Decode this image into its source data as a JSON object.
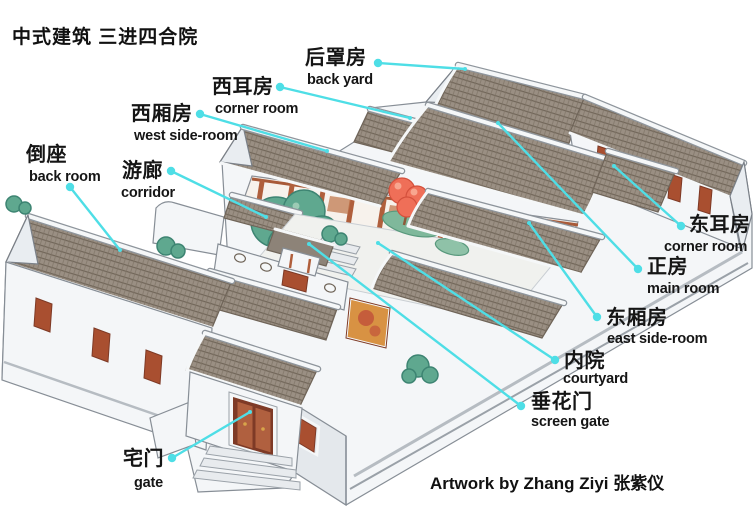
{
  "title": {
    "text": "中式建筑 三进四合院"
  },
  "credit": {
    "text": "Artwork by Zhang Ziyi 张紫仪"
  },
  "style": {
    "leader_color": "#4edee6",
    "text_color": "#151515"
  },
  "labels": [
    {
      "id": "hou-zhao-fang",
      "cn": "后罩房",
      "en": "back yard",
      "cn_pos": [
        305,
        48
      ],
      "en_pos": [
        307,
        73
      ],
      "dot": [
        378,
        63
      ],
      "end": [
        465,
        69
      ]
    },
    {
      "id": "xi-er-fang",
      "cn": "西耳房",
      "en": "corner room",
      "cn_pos": [
        212,
        77
      ],
      "en_pos": [
        215,
        102
      ],
      "dot": [
        280,
        87
      ],
      "end": [
        410,
        118
      ]
    },
    {
      "id": "xi-xiang-fang",
      "cn": "西厢房",
      "en": "west side-room",
      "cn_pos": [
        131,
        104
      ],
      "en_pos": [
        134,
        129
      ],
      "dot": [
        200,
        114
      ],
      "end": [
        327,
        151
      ]
    },
    {
      "id": "you-lang",
      "cn": "游廊",
      "en": "corridor",
      "cn_pos": [
        122,
        161
      ],
      "en_pos": [
        121,
        186
      ],
      "dot": [
        171,
        171
      ],
      "end": [
        266,
        217
      ]
    },
    {
      "id": "dao-zuo",
      "cn": "倒座",
      "en": "back room",
      "cn_pos": [
        26,
        145
      ],
      "en_pos": [
        29,
        170
      ],
      "dot": [
        70,
        187
      ],
      "end": [
        120,
        250
      ]
    },
    {
      "id": "zhai-men",
      "cn": "宅门",
      "en": "gate",
      "cn_pos": [
        123,
        449
      ],
      "en_pos": [
        134,
        476
      ],
      "dot": [
        172,
        458
      ],
      "end": [
        250,
        412
      ]
    },
    {
      "id": "dong-er-fang",
      "cn": "东耳房",
      "en": "corner room",
      "cn_pos": [
        689,
        215
      ],
      "en_pos": [
        664,
        240
      ],
      "dot": [
        681,
        226
      ],
      "end": [
        614,
        166
      ]
    },
    {
      "id": "zheng-fang",
      "cn": "正房",
      "en": "main room",
      "cn_pos": [
        647,
        257
      ],
      "en_pos": [
        647,
        282
      ],
      "dot": [
        638,
        269
      ],
      "end": [
        498,
        123
      ]
    },
    {
      "id": "dong-xiang-fang",
      "cn": "东厢房",
      "en": "east side-room",
      "cn_pos": [
        606,
        308
      ],
      "en_pos": [
        607,
        332
      ],
      "dot": [
        597,
        317
      ],
      "end": [
        529,
        223
      ]
    },
    {
      "id": "nei-yuan",
      "cn": "内院",
      "en": "courtyard",
      "cn_pos": [
        564,
        351
      ],
      "en_pos": [
        563,
        372
      ],
      "dot": [
        555,
        360
      ],
      "end": [
        378,
        243
      ]
    },
    {
      "id": "chui-hua-men",
      "cn": "垂花门",
      "en": "screen gate",
      "cn_pos": [
        531,
        392
      ],
      "en_pos": [
        531,
        415
      ],
      "dot": [
        521,
        406
      ],
      "end": [
        309,
        244
      ]
    }
  ]
}
